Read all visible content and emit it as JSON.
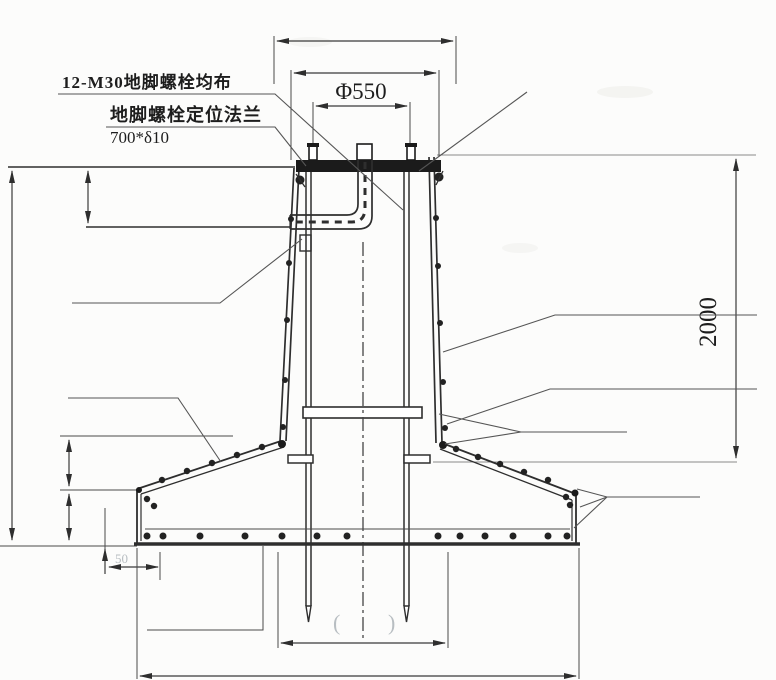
{
  "meta": {
    "drawing_type": "foundation cross-section detail",
    "background_color": "#fcfcfb",
    "ink_color": "#2e2e2e"
  },
  "labels": {
    "anchor_bolts": "12-M30地脚螺栓均布",
    "positioning_flange": "地脚螺栓定位法兰",
    "flange_size": "700*δ10"
  },
  "dimensions": {
    "bolt_circle_diameter": "Φ550",
    "foundation_height": "2000",
    "edge_offset": "50",
    "paren_left": "(",
    "paren_right": ")"
  }
}
